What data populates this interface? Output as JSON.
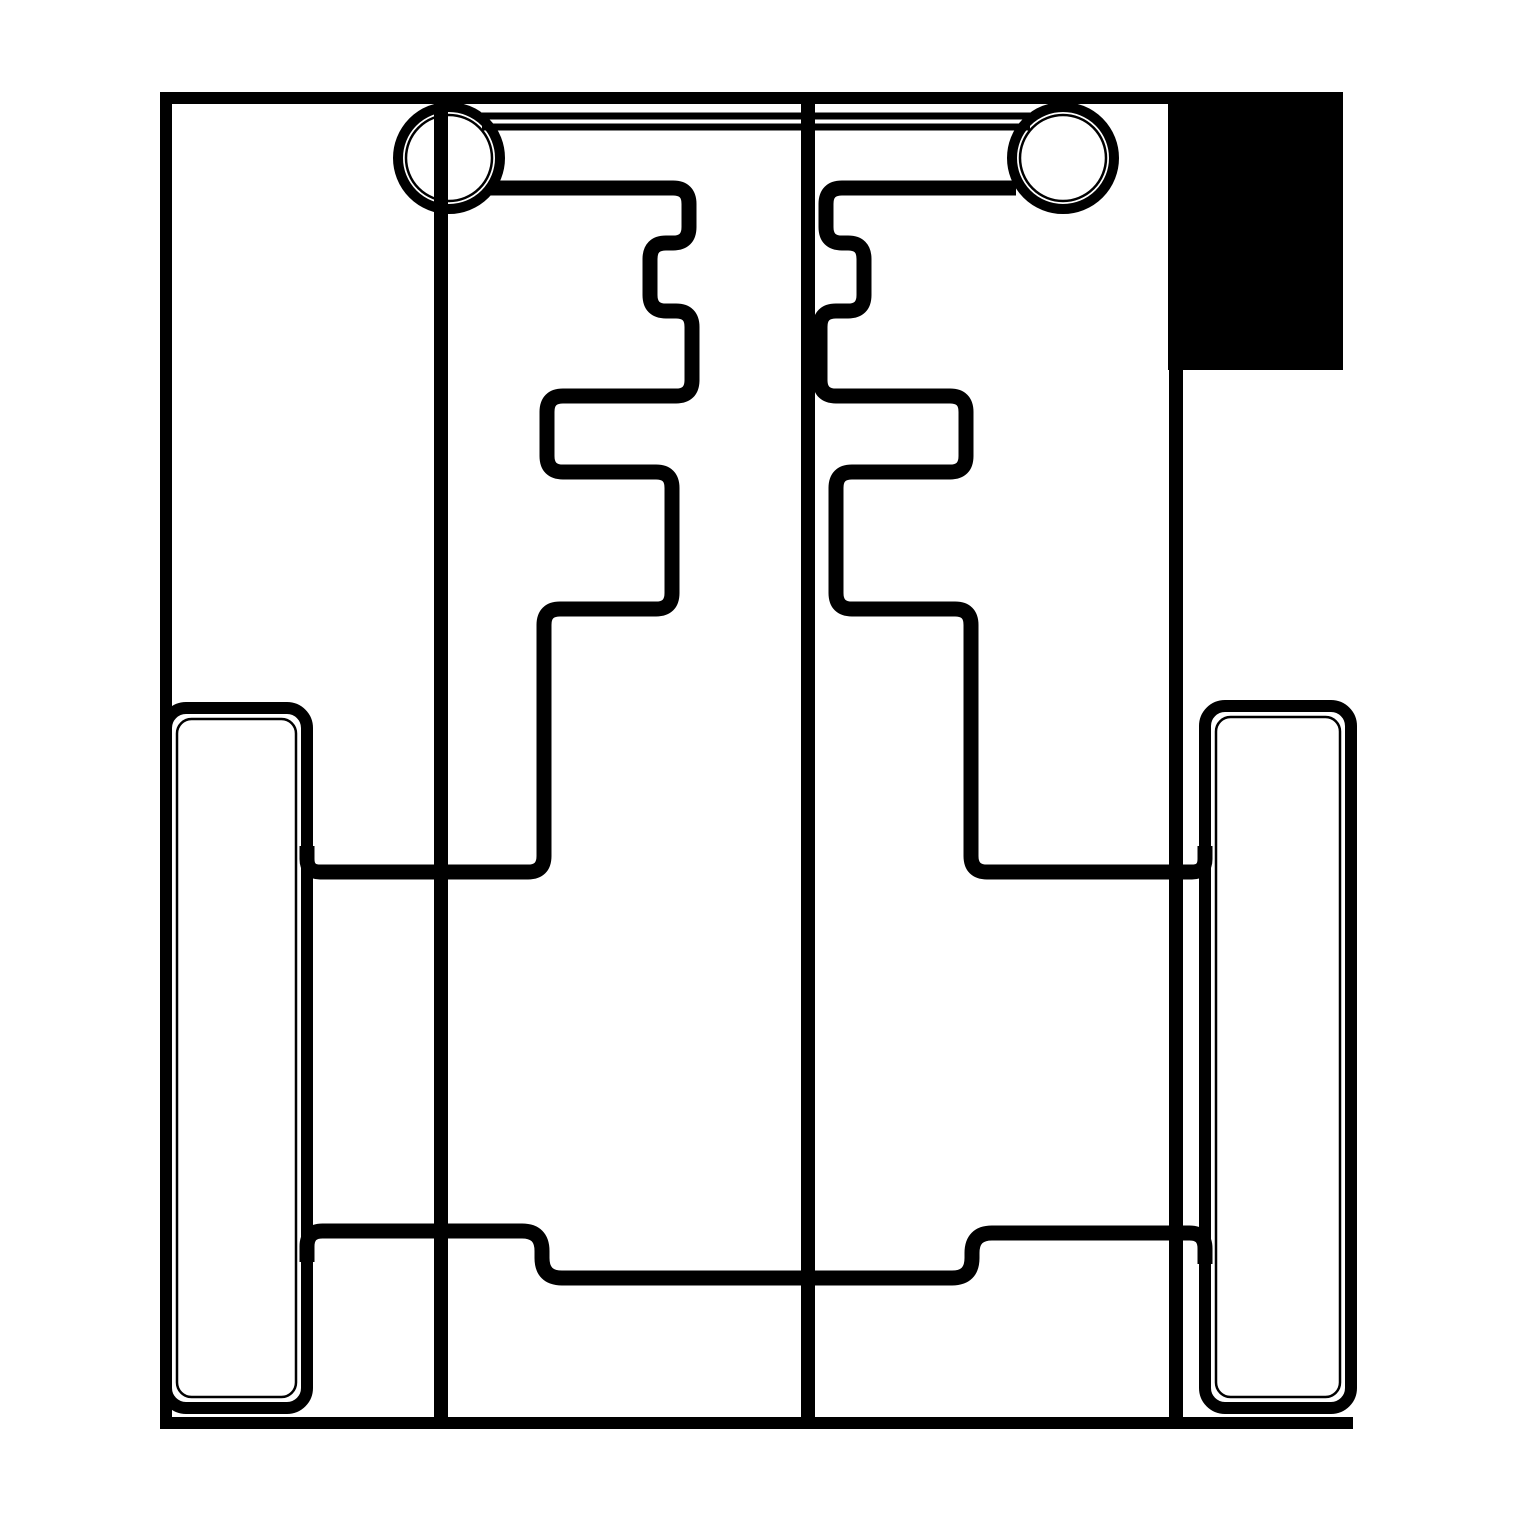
{
  "canvas": {
    "width": 1519,
    "height": 1519,
    "background_color": "#ffffff",
    "ink_color": "#000000"
  },
  "shapes": {
    "segments": [
      {
        "name": "outer-top-edge",
        "x1": 165,
        "y1": 98,
        "x2": 1343,
        "y2": 98,
        "width": 12
      },
      {
        "name": "outer-left-edge",
        "x1": 166,
        "y1": 92,
        "x2": 166,
        "y2": 1429,
        "width": 12
      },
      {
        "name": "outer-bottom-edge",
        "x1": 160,
        "y1": 1423,
        "x2": 1353,
        "y2": 1423,
        "width": 12
      },
      {
        "name": "outer-right-edge",
        "x1": 1176,
        "y1": 92,
        "x2": 1176,
        "y2": 1423,
        "width": 14
      },
      {
        "name": "fold-line-left",
        "x1": 441,
        "y1": 98,
        "x2": 441,
        "y2": 1423,
        "width": 14
      },
      {
        "name": "fold-line-center",
        "x1": 808,
        "y1": 98,
        "x2": 808,
        "y2": 1423,
        "width": 14
      },
      {
        "name": "strap-upper-line",
        "x1": 482,
        "y1": 116,
        "x2": 1030,
        "y2": 116,
        "width": 7
      },
      {
        "name": "strap-lower-line",
        "x1": 482,
        "y1": 127,
        "x2": 1030,
        "y2": 127,
        "width": 7
      }
    ],
    "polylines": [
      {
        "name": "stepped-slot-left",
        "width": 15,
        "corner_radius": 16,
        "points": [
          [
            490,
            188
          ],
          [
            689,
            188
          ],
          [
            689,
            243
          ],
          [
            650,
            243
          ],
          [
            650,
            311
          ],
          [
            692,
            311
          ],
          [
            692,
            396
          ],
          [
            547,
            396
          ],
          [
            547,
            472
          ],
          [
            672,
            472
          ],
          [
            672,
            609
          ],
          [
            544,
            609
          ],
          [
            544,
            872
          ],
          [
            307,
            872
          ],
          [
            307,
            846
          ]
        ]
      },
      {
        "name": "stepped-slot-right",
        "width": 15,
        "corner_radius": 16,
        "points": [
          [
            1016,
            188
          ],
          [
            826,
            188
          ],
          [
            826,
            243
          ],
          [
            864,
            243
          ],
          [
            864,
            311
          ],
          [
            820,
            311
          ],
          [
            820,
            396
          ],
          [
            966,
            396
          ],
          [
            966,
            472
          ],
          [
            836,
            472
          ],
          [
            836,
            609
          ],
          [
            971,
            609
          ],
          [
            971,
            872
          ],
          [
            1205,
            872
          ],
          [
            1205,
            846
          ]
        ]
      },
      {
        "name": "bottom-flap-line",
        "width": 15,
        "corner_radius": 20,
        "points": [
          [
            307,
            1262
          ],
          [
            307,
            1231
          ],
          [
            542,
            1231
          ],
          [
            542,
            1278
          ],
          [
            972,
            1278
          ],
          [
            972,
            1233
          ],
          [
            1205,
            1233
          ],
          [
            1205,
            1264
          ]
        ]
      }
    ],
    "rounded_rects": [
      {
        "name": "side-panel-left",
        "x": 166,
        "y": 708,
        "w": 141,
        "h": 700,
        "rx": 20,
        "stroke_width": 12,
        "inner_inset": 11,
        "inner_stroke_width": 2.5
      },
      {
        "name": "side-panel-right",
        "x": 1205,
        "y": 706,
        "w": 146,
        "h": 702,
        "rx": 20,
        "stroke_width": 12,
        "inner_inset": 11,
        "inner_stroke_width": 2.5
      }
    ],
    "circles": [
      {
        "name": "rivet-hole-left",
        "cx": 449,
        "cy": 158,
        "r_outer": 51,
        "outer_stroke_width": 10,
        "r_inner": 43,
        "inner_stroke_width": 2.5
      },
      {
        "name": "rivet-hole-right",
        "cx": 1063,
        "cy": 158,
        "r_outer": 51,
        "outer_stroke_width": 10,
        "r_inner": 43,
        "inner_stroke_width": 2.5
      }
    ],
    "filled_rects": [
      {
        "name": "corner-fill-block",
        "x": 1168,
        "y": 92,
        "w": 175,
        "h": 278
      }
    ]
  }
}
